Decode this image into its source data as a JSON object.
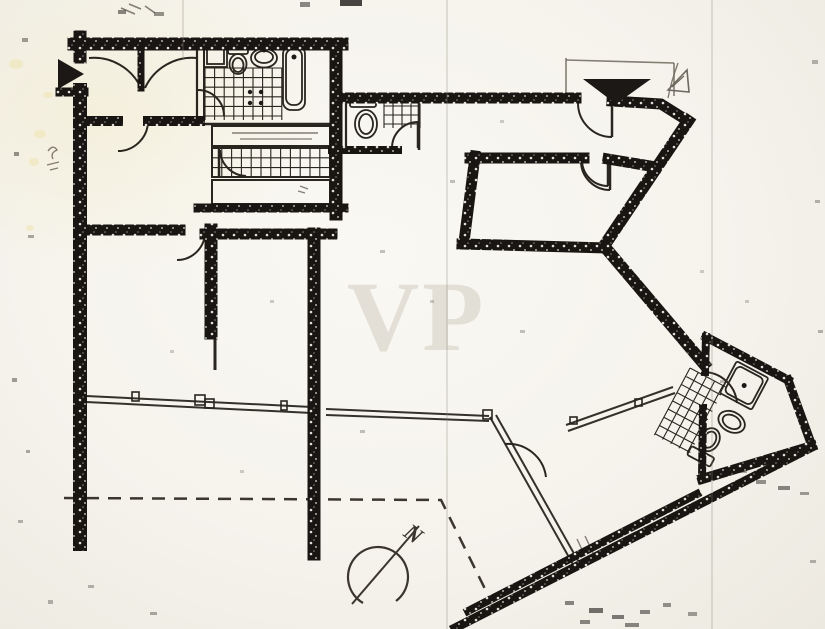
{
  "artifact": {
    "kind": "scanned-floor-plan",
    "watermark": {
      "text": "VP"
    },
    "compass": {
      "label": "N"
    }
  },
  "palette": {
    "paper": "#f7f5f0",
    "ink": "#1c1815",
    "line": "#29251f",
    "pencil": "#6e695e",
    "stain": "#efe3ae",
    "fold": "#8b8578"
  },
  "floorplan": {
    "rotated_group_transform": "translate(712,348) rotate(28)",
    "thick_walls": [
      [
        "M74 44 H342",
        13
      ],
      [
        "M80 37 V57",
        13
      ],
      [
        "M80 90 V544",
        14
      ],
      [
        "M60 92 H84",
        9
      ],
      [
        "M336 44 V214",
        13
      ],
      [
        "M336 98 H576",
        11
      ],
      [
        "M612 101 L661 104 L688 121",
        11
      ],
      [
        "M688 121 L604 246",
        12
      ],
      [
        "M604 246 L704 364",
        12
      ],
      [
        "M470 158 H584",
        11
      ],
      [
        "M608 159 L656 167",
        11
      ],
      [
        "M475 156 L464 242",
        11
      ],
      [
        "M462 244 L606 248",
        11
      ],
      [
        "M86 121 H118",
        10
      ],
      [
        "M148 121 H200",
        10
      ],
      [
        "M86 230 H180",
        11
      ],
      [
        "M205 234 H332",
        11
      ],
      [
        "M211 230 V333",
        13
      ],
      [
        "M314 234 V554",
        13
      ],
      [
        "M198 208 H344",
        9
      ],
      [
        "M332 150 H398",
        8
      ],
      [
        "M141 46 V88",
        7
      ],
      [
        "M455 628 L812 447",
        9
      ],
      [
        "M468 611 L697 494",
        8
      ],
      [
        "M706 337 L788 380",
        9
      ],
      [
        "M788 380 L812 446",
        9
      ],
      [
        "M812 446 L702 479",
        10
      ],
      [
        "M706 337 L705 372",
        8
      ],
      [
        "M703 408 L702 479",
        8
      ]
    ],
    "thin_lines": [
      [
        "M197 46 V124",
        2.2
      ],
      [
        "M204 46 V124",
        2
      ],
      [
        "M197 124 H333",
        2.4
      ],
      [
        "M212 126 H330 V146 H212 Z",
        2
      ],
      [
        "M212 148 H330 V177 H212 Z",
        2
      ],
      [
        "M212 180 H330 V204 H212 Z",
        2
      ],
      [
        "M346 96 V149",
        2.2
      ],
      [
        "M419 94 V150",
        2.6
      ],
      [
        "M215 332 V370",
        3
      ]
    ],
    "pencil_lines": [
      [
        "M566 58 V100",
        1.6
      ],
      [
        "M566 60 L674 63",
        1.6
      ],
      [
        "M674 63 V96",
        1.6
      ],
      [
        "M678 63 Q671 82 668 98",
        1.4
      ],
      [
        "M48 151 q5 -7 9 -1 q-7 3 -4 9",
        1.4
      ],
      [
        "M47 165 l12 -3 M50 170 l8 -2",
        1.3
      ],
      [
        "M121 8 l14 6 M129 4 l12 5 M145 6 l10 7",
        1.6
      ],
      [
        "M232 133 H318",
        1.4
      ],
      [
        "M240 139 H312",
        1.2
      ],
      [
        "M300 186 l8 3 M298 191 l7 2",
        1.3
      ],
      [
        "M577 539 l8 17 M585 536 l8 17",
        1.4
      ]
    ],
    "door_leaves": [
      "M612 103 V137",
      "M610 161 V190",
      "M608 160 V186",
      "M418 122 V148",
      "M219 149 V177"
    ],
    "door_arcs": [
      "M89 58 A52 52 0 0 1 141 88",
      "M197 58 A52 52 0 0 0 145 88",
      "M148 121 A30 30 0 0 1 118 151",
      "M198 90 A26 26 0 0 1 224 116",
      "M220 150 A27 27 0 0 0 246 176",
      "M205 232 A28 28 0 0 1 177 260",
      "M612 137 A34 34 0 0 1 578 103",
      "M610 190 A29 29 0 0 1 581 161",
      "M608 186 A26 26 0 0 1 582 160",
      "M418 122 A26 26 0 0 0 392 148",
      "M505 444 A38 38 0 0 1 546 477",
      "M704 372 A34 34 0 0 1 737 403"
    ],
    "window_lines": [
      "M86 396 L312 407",
      "M86 402 L312 413",
      "M326 409 L489 416",
      "M326 415 L489 421",
      "M490 417 L575 568",
      "M496 415 L581 566",
      "M566 425 L673 387",
      "M568 431 L675 393"
    ],
    "window_ticks": [
      [
        132,
        392,
        7,
        9
      ],
      [
        195,
        395,
        10,
        10
      ],
      [
        205,
        399,
        9,
        9
      ],
      [
        281,
        401,
        6,
        9
      ],
      [
        483,
        410,
        9,
        9
      ],
      [
        570,
        417,
        7,
        7
      ],
      [
        635,
        399,
        7,
        7
      ]
    ],
    "dashed_boundary": {
      "d": "M64 498 L441 500 L489 597",
      "dash": "13 9"
    },
    "tile_areas": [
      {
        "x": 205,
        "y": 68,
        "w": 77,
        "h": 52,
        "cell": 9.6,
        "transform": ""
      },
      {
        "x": 212,
        "y": 148,
        "w": 118,
        "h": 29,
        "cell": 9.8,
        "transform": ""
      },
      {
        "x": 384,
        "y": 97,
        "w": 36,
        "h": 31,
        "cell": 9,
        "transform": ""
      },
      {
        "x": -10,
        "y": 28,
        "w": 40,
        "h": 76,
        "cell": 9.3,
        "transform": "rb"
      }
    ],
    "fixture_rects": [
      [
        204,
        46,
        23,
        21,
        0,
        ""
      ],
      [
        207,
        49,
        17,
        15,
        0,
        ""
      ],
      [
        228,
        46,
        20,
        8,
        2,
        ""
      ],
      [
        283,
        46,
        22,
        64,
        8,
        ""
      ],
      [
        286,
        49,
        16,
        56,
        7,
        ""
      ],
      [
        350,
        96,
        26,
        11,
        2,
        ""
      ],
      [
        28,
        0,
        36,
        36,
        2,
        "rb"
      ],
      [
        31,
        3,
        30,
        30,
        5,
        "rb"
      ],
      [
        28,
        96,
        26,
        10,
        2,
        "rb"
      ]
    ],
    "fixture_ellipses": [
      [
        238,
        64,
        8.5,
        10,
        ""
      ],
      [
        238,
        65,
        5.5,
        7,
        ""
      ],
      [
        264,
        58,
        13,
        9.5,
        ""
      ],
      [
        264,
        57,
        9,
        6,
        ""
      ],
      [
        366,
        124,
        11,
        14,
        ""
      ],
      [
        366,
        124,
        7,
        10,
        ""
      ],
      [
        52,
        56,
        14,
        10,
        "rb"
      ],
      [
        52,
        56,
        9.5,
        6.5,
        "rb"
      ],
      [
        41,
        82,
        9.5,
        12,
        "rb"
      ],
      [
        41,
        82,
        6,
        8.5,
        "rb"
      ]
    ],
    "fixture_dots": [
      [
        294,
        57,
        2.5,
        ""
      ],
      [
        264,
        51,
        1.5,
        ""
      ],
      [
        250,
        92,
        2.2,
        ""
      ],
      [
        261,
        92,
        2.2,
        ""
      ],
      [
        250,
        103,
        2.2,
        ""
      ],
      [
        261,
        103,
        2.2,
        ""
      ],
      [
        46,
        18,
        2.5,
        "rb"
      ]
    ],
    "triangles": [
      {
        "points": "58,59 58,89 84,74",
        "style": "solid"
      },
      {
        "points": "583,79 651,79 616,104",
        "style": "solid"
      },
      {
        "points": "668,90 687,70 689,92",
        "style": "outline"
      }
    ],
    "triangle_inner_line": "M672 87 L684 76",
    "compass": {
      "arc_d": "M363 603 A30 30 0 1 1 396 601",
      "needle": "M352 604 L419 526"
    },
    "stains": [
      [
        16,
        64,
        7,
        5
      ],
      [
        40,
        134,
        6,
        4
      ],
      [
        34,
        162,
        5,
        4
      ],
      [
        30,
        228,
        4,
        3
      ],
      [
        48,
        95,
        5,
        3
      ]
    ],
    "folds": [
      [
        183,
        0,
        183,
        60
      ],
      [
        447,
        0,
        447,
        629
      ],
      [
        712,
        0,
        712,
        629
      ]
    ],
    "speckles": [
      [
        340,
        0,
        22,
        6,
        0.8
      ],
      [
        300,
        2,
        10,
        5,
        0.5
      ],
      [
        118,
        10,
        8,
        4,
        0.5
      ],
      [
        154,
        12,
        10,
        4,
        0.45
      ],
      [
        22,
        38,
        6,
        4,
        0.4
      ],
      [
        14,
        152,
        5,
        4,
        0.45
      ],
      [
        28,
        235,
        6,
        3,
        0.35
      ],
      [
        12,
        378,
        5,
        4,
        0.4
      ],
      [
        26,
        450,
        4,
        3,
        0.35
      ],
      [
        18,
        520,
        5,
        3,
        0.3
      ],
      [
        88,
        585,
        6,
        3,
        0.3
      ],
      [
        150,
        612,
        7,
        3,
        0.35
      ],
      [
        48,
        600,
        5,
        4,
        0.3
      ],
      [
        565,
        601,
        9,
        4,
        0.5
      ],
      [
        589,
        608,
        14,
        5,
        0.6
      ],
      [
        612,
        615,
        12,
        4,
        0.55
      ],
      [
        640,
        610,
        10,
        4,
        0.5
      ],
      [
        663,
        603,
        8,
        4,
        0.45
      ],
      [
        688,
        612,
        9,
        4,
        0.4
      ],
      [
        580,
        620,
        10,
        4,
        0.5
      ],
      [
        625,
        623,
        14,
        4,
        0.5
      ],
      [
        756,
        480,
        10,
        4,
        0.45
      ],
      [
        778,
        486,
        12,
        4,
        0.5
      ],
      [
        800,
        492,
        9,
        3,
        0.4
      ],
      [
        740,
        470,
        7,
        3,
        0.35
      ],
      [
        812,
        60,
        6,
        4,
        0.3
      ],
      [
        815,
        200,
        5,
        3,
        0.3
      ],
      [
        818,
        330,
        5,
        3,
        0.3
      ],
      [
        810,
        560,
        6,
        3,
        0.3
      ],
      [
        380,
        250,
        5,
        3,
        0.25
      ],
      [
        430,
        300,
        4,
        3,
        0.2
      ],
      [
        520,
        330,
        5,
        3,
        0.25
      ],
      [
        270,
        300,
        4,
        3,
        0.2
      ],
      [
        360,
        430,
        5,
        3,
        0.25
      ],
      [
        240,
        470,
        4,
        3,
        0.2
      ],
      [
        170,
        350,
        4,
        3,
        0.2
      ],
      [
        450,
        180,
        5,
        3,
        0.25
      ],
      [
        500,
        120,
        4,
        3,
        0.2
      ],
      [
        700,
        270,
        4,
        3,
        0.2
      ],
      [
        745,
        300,
        4,
        3,
        0.2
      ],
      [
        720,
        380,
        5,
        3,
        0.25
      ]
    ]
  }
}
